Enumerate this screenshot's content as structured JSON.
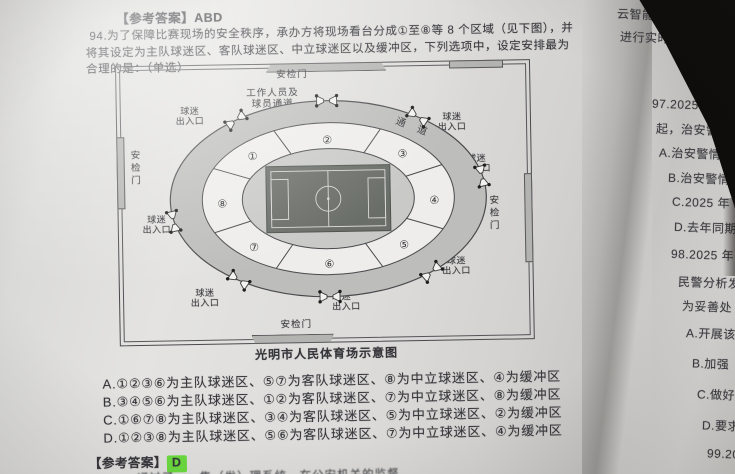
{
  "colors": {
    "paper": "#dedddb",
    "ink": "#35353a",
    "highlight": "#6bdc3e",
    "field": "#6a6e68",
    "ring": "#bdbdbb"
  },
  "header_answer": {
    "label": "【参考答案】",
    "value": "ABD"
  },
  "question": {
    "lines": [
      "94.为了保障比赛现场的安全秩序，承办方将现场看台分成①至⑧等 8 个区域（见下图），并",
      "将其设定为主队球迷区、客队球迷区、中立球迷区以及缓冲区，下列选项中，设定安排最为",
      "合理的是：（单选）"
    ]
  },
  "diagram": {
    "caption": "光明市人民体育场示意图",
    "security_gate_label": "安检门",
    "staff_passage_line1": "工作人员及",
    "staff_passage_line2": "球员通道",
    "fan_entrance_line1": "球迷",
    "fan_entrance_line2": "出入口",
    "ring_passage_label": "通 道",
    "sections": [
      "①",
      "②",
      "③",
      "④",
      "⑤",
      "⑥",
      "⑦",
      "⑧"
    ]
  },
  "options": [
    {
      "label": "A.",
      "text": "①②③⑥为主队球迷区、⑤⑦为客队球迷区、⑧为中立球迷区、④为缓冲区"
    },
    {
      "label": "B.",
      "text": "③④⑤⑥为主队球迷区、①②为客队球迷区、⑦为中立球迷区、⑧为缓冲区"
    },
    {
      "label": "C.",
      "text": "①⑥⑦⑧为主队球迷区、③④为客队球迷区、⑤为中立球迷区、②为缓冲区"
    },
    {
      "label": "D.",
      "text": "①②③⑧为主队球迷区、⑤⑥为客队球迷区、⑦为中立球迷区、④为缓冲区"
    }
  ],
  "footer_answer": {
    "label": "【参考答案】",
    "value": "D",
    "highlight_style": "background:#6bdc3e"
  },
  "footer_partial": "……通过了……集（发）理系统，在公安机关的监督",
  "right_column": {
    "fragments": [
      "云智能警情",
      "进行实时直",
      "97.2025 年 10",
      "起，治安警情",
      "A.治安警情接",
      "B.治安警情接",
      "C.2025 年 10",
      "D.去年同期",
      "98.2025 年",
      "民警分析发",
      "为妥善处",
      "A.开展该",
      "B.加强",
      "C.做好",
      "D.要求",
      "99.20"
    ]
  }
}
